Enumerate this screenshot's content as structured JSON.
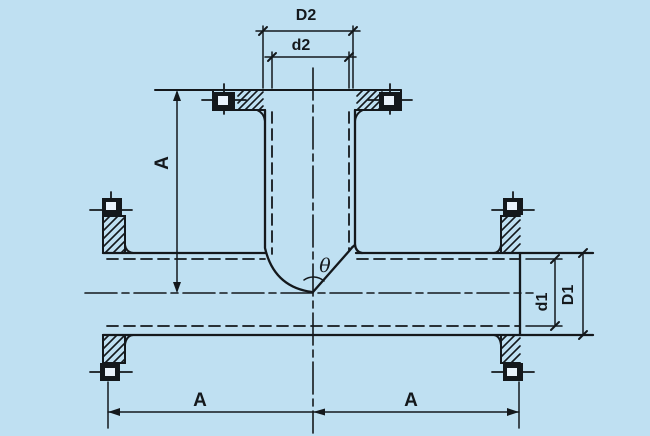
{
  "canvas": {
    "background": "#bfe0f2",
    "line_color": "#14181c",
    "slot_color": "#e9f2fb"
  },
  "labels": {
    "branch_od": "D2",
    "branch_id": "d2",
    "branch_length": "A",
    "angle": "θ",
    "run_id": "d1",
    "run_od": "D1",
    "left_run_length": "A",
    "right_run_length": "A"
  }
}
